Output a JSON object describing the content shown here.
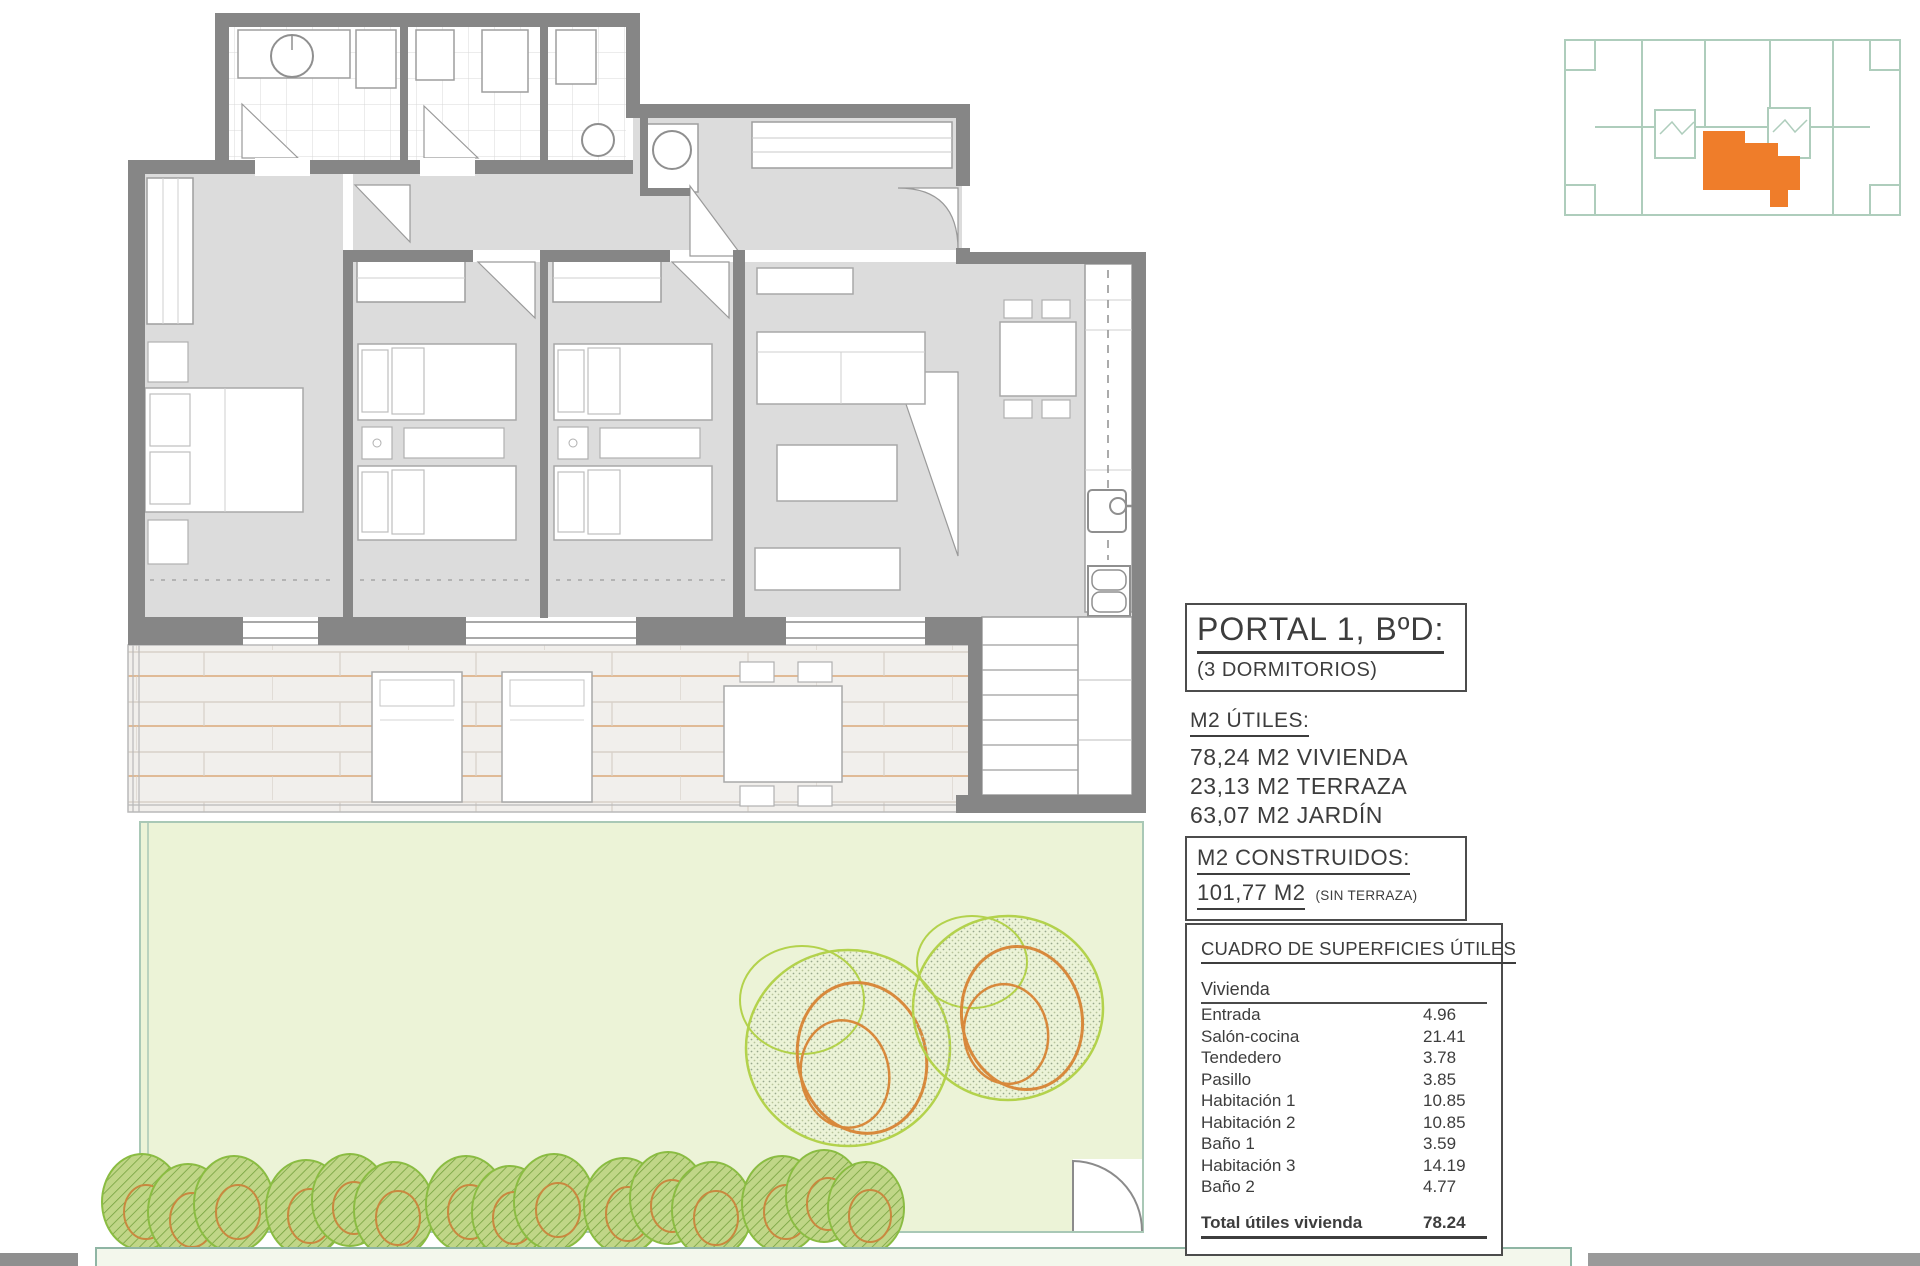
{
  "panel": {
    "title": "PORTAL 1, BºD:",
    "subtitle": "(3 DORMITORIOS)",
    "m2_utiles": {
      "heading": "M2 ÚTILES:",
      "lines": [
        "78,24 M2 VIVIENDA",
        "23,13 M2 TERRAZA",
        "63,07 M2 JARDÍN"
      ]
    },
    "m2_construidos": {
      "heading": "M2 CONSTRUIDOS:",
      "value": "101,77 M2",
      "note": "(SIN TERRAZA)"
    },
    "surfaces_table": {
      "title": "CUADRO DE SUPERFICIES ÚTILES",
      "group": "Vivienda",
      "rows": [
        {
          "label": "Entrada",
          "value": "4.96"
        },
        {
          "label": "Salón-cocina",
          "value": "21.41"
        },
        {
          "label": "Tendedero",
          "value": "3.78"
        },
        {
          "label": "Pasillo",
          "value": "3.85"
        },
        {
          "label": "Habitación 1",
          "value": "10.85"
        },
        {
          "label": "Habitación 2",
          "value": "10.85"
        },
        {
          "label": "Baño 1",
          "value": "3.59"
        },
        {
          "label": "Habitación 3",
          "value": "14.19"
        },
        {
          "label": "Baño 2",
          "value": "4.77"
        }
      ],
      "total_label": "Total útiles vivienda",
      "total_value": "78.24"
    }
  },
  "colors": {
    "wall_gray": "#868686",
    "room_gray": "#dcdcdc",
    "deck_tan": "#daa97a",
    "garden_green": "#ecf3d7",
    "plan_outline_teal": "#a9c8b6",
    "tree_green": "#b3d24c",
    "tree_orange": "#d8893c",
    "keyplan_line": "#aecdbc",
    "keyplan_highlight": "#ef7d2a",
    "text_dark": "#3d3d3d"
  }
}
